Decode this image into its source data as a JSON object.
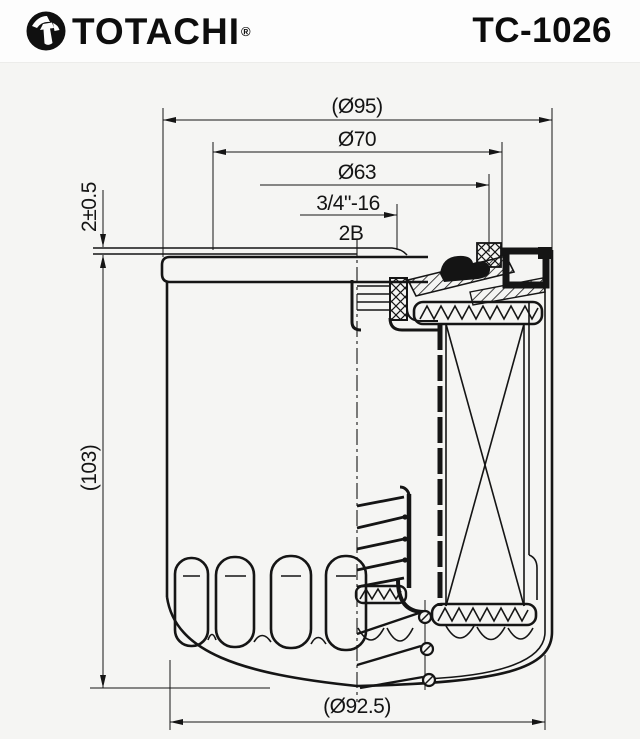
{
  "header": {
    "brand": "TOTACHI",
    "registered": "®",
    "part_number": "TC-1026"
  },
  "drawing": {
    "description": "oil filter cross-section technical drawing",
    "dims": {
      "d95": "(Ø95)",
      "d70": "Ø70",
      "d63": "Ø63",
      "thread": "3/4\"-16",
      "thread_class": "2B",
      "rim": "2±0.5",
      "height": "(103)",
      "d92_5": "(Ø92.5)"
    }
  },
  "colors": {
    "line": "#151515",
    "header_bg": "#fdfdfd",
    "drawing_bg": "#f5f5f3",
    "text": "#0e0e0e"
  }
}
